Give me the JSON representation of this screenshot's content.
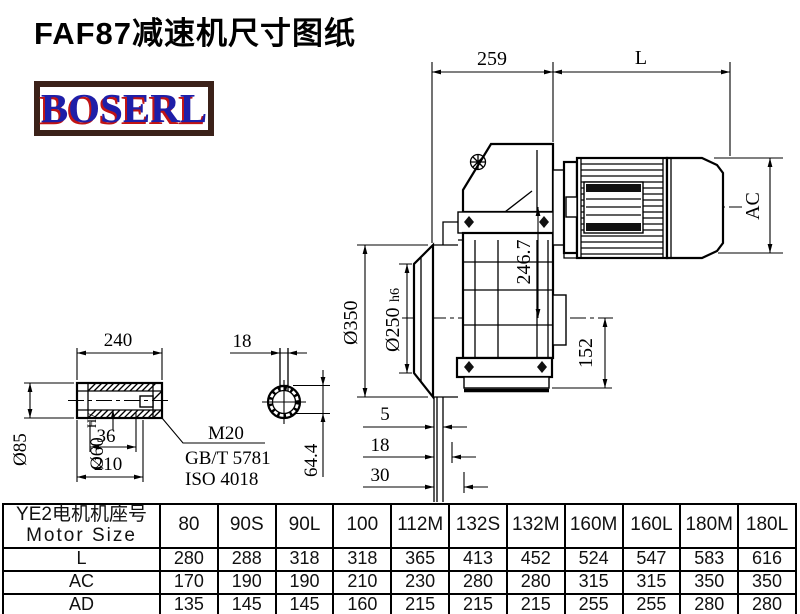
{
  "title": "FAF87减速机尺寸图纸",
  "logo": {
    "text": "BOSERL"
  },
  "drawing": {
    "main_view": {
      "dim_259": "259",
      "dim_L": "L",
      "dim_AC": "AC",
      "dim_246_7": "246.7",
      "dim_152": "152",
      "dim_350": "Ø350",
      "dim_250": "Ø250",
      "dim_250_tol": "h6",
      "dim_5": "5",
      "dim_18": "18",
      "dim_30": "30"
    },
    "shaft_view": {
      "dim_240": "240",
      "dim_36": "36",
      "dim_210": "210",
      "dim_85": "Ø85",
      "dim_60": "Ø60",
      "dim_60_tol": "H7",
      "thread": "M20",
      "standard_gb": "GB/T 5781",
      "standard_iso": "ISO 4018"
    },
    "section_view": {
      "dim_18": "18",
      "dim_64_4": "64.4"
    }
  },
  "table": {
    "header": {
      "line1": "YE2电机机座号",
      "line2": "Motor Size"
    },
    "columns": [
      "80",
      "90S",
      "90L",
      "100",
      "112M",
      "132S",
      "132M",
      "160M",
      "160L",
      "180M",
      "180L"
    ],
    "rows": [
      {
        "label": "L",
        "values": [
          "280",
          "288",
          "318",
          "318",
          "365",
          "413",
          "452",
          "524",
          "547",
          "583",
          "616"
        ]
      },
      {
        "label": "AC",
        "values": [
          "170",
          "190",
          "190",
          "210",
          "230",
          "280",
          "280",
          "315",
          "315",
          "350",
          "350"
        ]
      },
      {
        "label": "AD",
        "values": [
          "135",
          "145",
          "145",
          "160",
          "215",
          "215",
          "215",
          "255",
          "255",
          "280",
          "280"
        ]
      }
    ]
  }
}
